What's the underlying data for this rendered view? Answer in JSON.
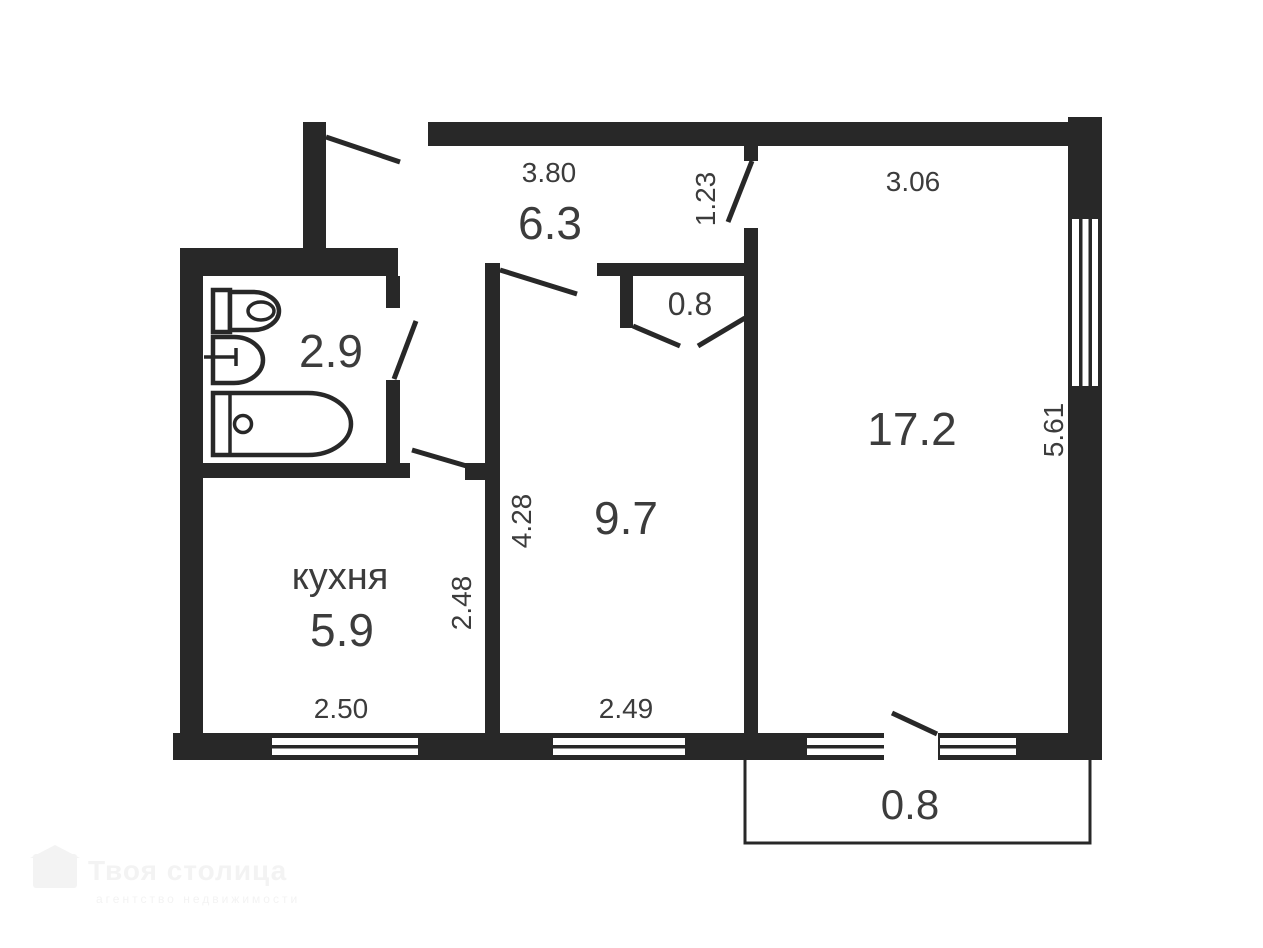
{
  "plan": {
    "colors": {
      "wall": "#282828",
      "text": "#3c3c3c",
      "background": "#ffffff",
      "watermark": "#f3f3f3"
    },
    "labels": {
      "hallway_area": "6.3",
      "bathroom_area": "2.9",
      "kitchen_name": "кухня",
      "kitchen_area": "5.9",
      "room_mid_area": "9.7",
      "room_large_area": "17.2",
      "closet_area": "0.8",
      "balcony_area": "0.8"
    },
    "dimensions": {
      "hall_width": "3.80",
      "large_room_door": "1.23",
      "large_room_width": "3.06",
      "large_room_height": "5.61",
      "mid_room_height": "4.28",
      "mid_room_width": "2.49",
      "kitchen_height": "2.48",
      "kitchen_width": "2.50"
    },
    "watermark": {
      "brand": "Твоя столица",
      "tagline": "агентство недвижимости"
    }
  }
}
